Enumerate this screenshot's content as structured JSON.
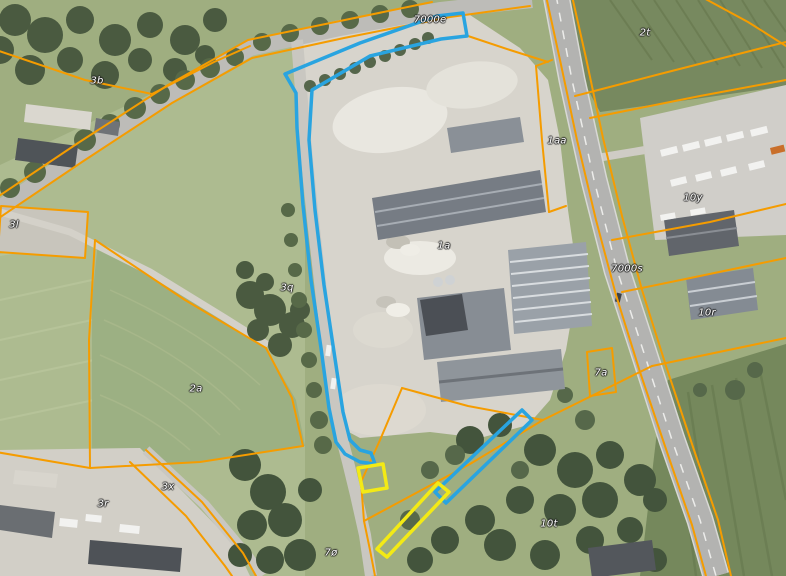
{
  "map": {
    "view": "aerial-orthophoto-with-cadastral-overlay",
    "colors": {
      "cadastral_boundary": "#F59C00",
      "highlight_blue": "#29A4E0",
      "highlight_yellow": "#F3EA15",
      "label_text": "#FFFFFF"
    },
    "parcel_labels": [
      {
        "text": "7000e",
        "x": 430,
        "y": 20
      },
      {
        "text": "3b",
        "x": 97,
        "y": 81
      },
      {
        "text": "2t",
        "x": 645,
        "y": 33
      },
      {
        "text": "1aa",
        "x": 557,
        "y": 141
      },
      {
        "text": "10y",
        "x": 693,
        "y": 198
      },
      {
        "text": "3l",
        "x": 14,
        "y": 225
      },
      {
        "text": "3q",
        "x": 287,
        "y": 288
      },
      {
        "text": "1a",
        "x": 444,
        "y": 246
      },
      {
        "text": "7000s",
        "x": 627,
        "y": 269
      },
      {
        "text": "10r",
        "x": 707,
        "y": 313
      },
      {
        "text": "7a",
        "x": 601,
        "y": 373
      },
      {
        "text": "2a",
        "x": 196,
        "y": 389
      },
      {
        "text": "3x",
        "x": 168,
        "y": 487
      },
      {
        "text": "3r",
        "x": 103,
        "y": 504
      },
      {
        "text": "7ø",
        "x": 331,
        "y": 553
      },
      {
        "text": "10t",
        "x": 549,
        "y": 524
      }
    ]
  }
}
